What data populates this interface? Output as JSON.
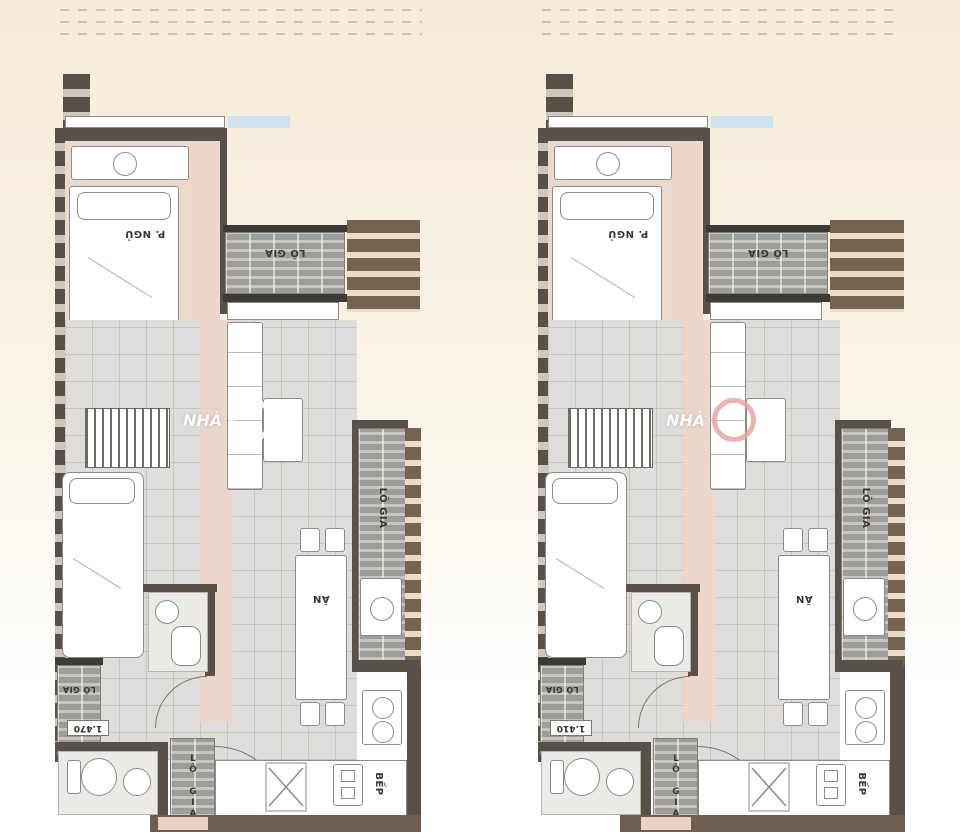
{
  "page": {
    "type": "apartment-floor-plan-sheet",
    "background": "#f8f0e1"
  },
  "colors": {
    "wall_dark": "#57514a",
    "wall_black": "#3c3a37",
    "wall_brown": "#6f5d50",
    "loggia_hatch": "#9e9d99",
    "tile_floor": "#dedddb",
    "bedroom_floor": "#ebdacb",
    "pink_accent": "#eed6c9",
    "window_blue": "#cfe3ee",
    "watermark_white": "#ffffff",
    "watermark_pink": "#e9a5a0"
  },
  "plans": [
    {
      "name": "unit-left",
      "labels": {
        "bedroom": "P. NGỦ",
        "loggia_top": "LÔ GIA",
        "loggia_side": "LÔ GIA",
        "loggia_service": "LÔ GIA",
        "loggia_entry": "LÔ GIA",
        "dining": "ĂN",
        "kitchen": "BẾP"
      },
      "dimensions": {
        "service_loggia": "1.470"
      },
      "watermark": "NHÀ"
    },
    {
      "name": "unit-right",
      "labels": {
        "bedroom": "P. NGỦ",
        "loggia_top": "LÔ GIA",
        "loggia_side": "LÔ GIA",
        "loggia_service": "LÔ GIA",
        "loggia_entry": "LÔ GIA",
        "dining": "ĂN",
        "kitchen": "BẾP"
      },
      "dimensions": {
        "service_loggia": "1.410"
      },
      "watermark": "NHÀ"
    }
  ]
}
